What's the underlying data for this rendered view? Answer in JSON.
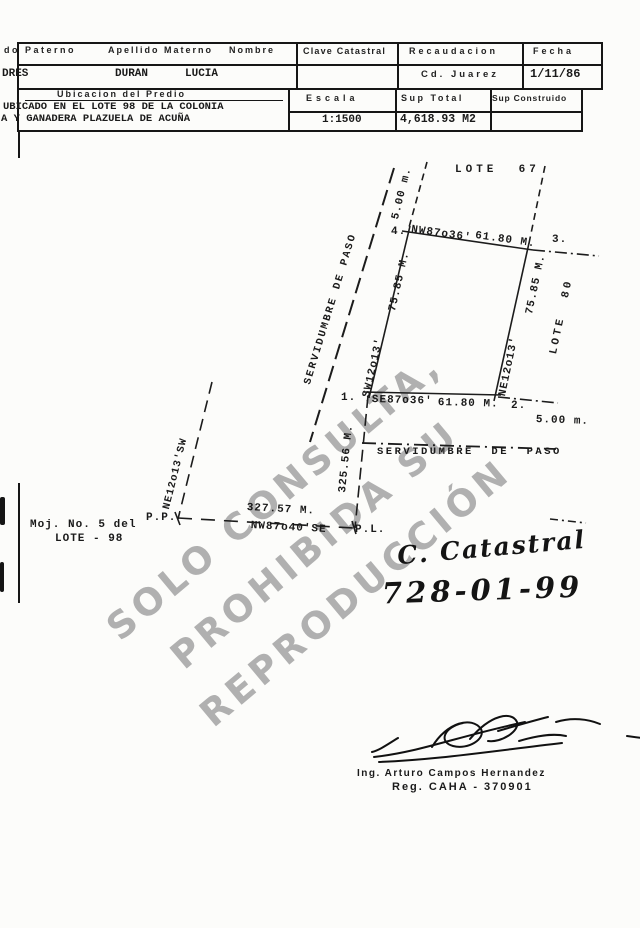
{
  "form": {
    "row1": {
      "paterno_label": "do Paterno",
      "materno_label": "Apellido Materno",
      "nombre_label": "Nombre",
      "clave_label": "Clave Catastral",
      "recaudacion_label": "Recaudacion",
      "fecha_label": "Fecha"
    },
    "row2": {
      "paterno_value": "DRES",
      "materno_value": "DURAN",
      "nombre_value": "LUCIA",
      "recaudacion_value": "Cd. Juarez",
      "fecha_value": "1/11/86"
    },
    "row3": {
      "ubicacion_label": "Ubicacion del Predio",
      "escala_label": "Escala",
      "sup_total_label": "Sup Total",
      "sup_construido_label": "Sup Construido"
    },
    "row4": {
      "ubicacion_line1": "UBICADO EN EL LOTE 98 DE LA COLONIA",
      "ubicacion_line2": "A Y GANADERA PLAZUELA DE ACUÑA",
      "escala_value": "1:1500",
      "sup_total_value": "4,618.93 M2",
      "sup_construido_value": ""
    }
  },
  "plan": {
    "adjacent_lot_top": "LOTE  67",
    "adjacent_lot_right": "LOTE  80",
    "corner_1": "1.",
    "corner_2": "2.",
    "corner_3": "3.",
    "corner_4": "4.",
    "top_edge": {
      "bearing": "NW87o36'",
      "length": "61.80 M."
    },
    "bottom_edge": {
      "bearing": "SE87o36'",
      "length": "61.80 M."
    },
    "left_edge": {
      "bearing": "SW12o13'",
      "length": "75.85 M."
    },
    "right_edge": {
      "bearing": "NE12o13'",
      "length": "75.85 M."
    },
    "top_offset": "5.00 m.",
    "bottom_offset": "5.00 m.",
    "easement_diagonal": "SERVIDUMBRE DE PASO",
    "easement_horizontal": "SERVIDUMBRE  DE  PASO",
    "west_line_length": "325.56 M.",
    "west_line_bearing": "NE12o13'SW",
    "point_pp": "P.P.",
    "point_pl": "P.L.",
    "base_line": {
      "length": "327.57 M.",
      "bearing": "NW87o40'SE"
    },
    "monument_note_line1": "Moj. No. 5 del",
    "monument_note_line2": "LOTE - 98"
  },
  "watermark": {
    "line1": "SOLO CONSULTA,",
    "line2": "PROHIBIDA SU",
    "line3": "REPRODUCCIÓN"
  },
  "annotation": {
    "line1": "C. Catastral",
    "line2": "728-01-99"
  },
  "signature": {
    "name": "Ing. Arturo Campos Hernandez",
    "registration": "Reg. CAHA - 370901"
  }
}
